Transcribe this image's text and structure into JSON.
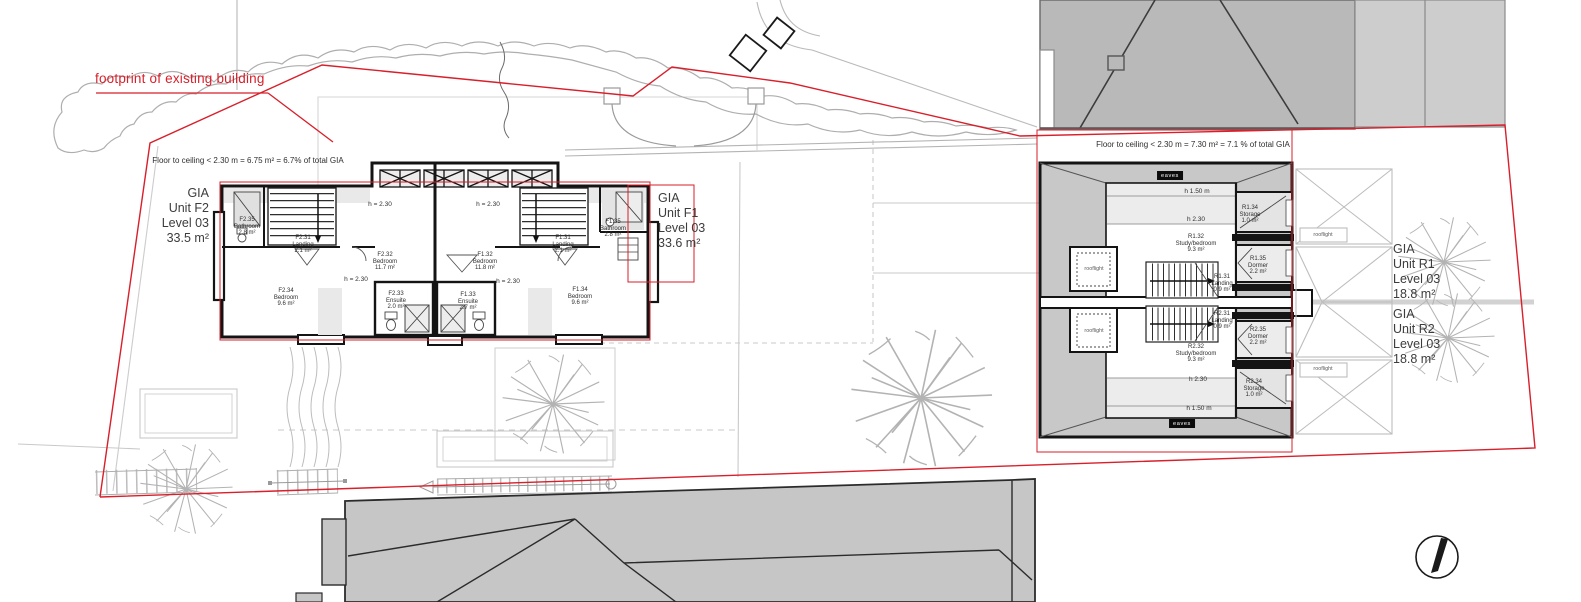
{
  "annotations": {
    "footprint": "footprint of existing building",
    "ceiling_left": "Floor to ceiling < 2.30 m = 6.75 m² = 6.7% of total GIA",
    "ceiling_right": "Floor to ceiling < 2.30 m = 7.30 m² = 7.1 % of total GIA",
    "eaves": "eaves",
    "rooflight": "rooflight",
    "h_eq_230": "h = 2.30",
    "h_230": "h 2.30",
    "h_150": "h 1.50 m"
  },
  "units": {
    "f2": {
      "gia": "GIA",
      "unit": "Unit F2",
      "level": "Level 03",
      "area": "33.5 m²"
    },
    "f1": {
      "gia": "GIA",
      "unit": "Unit F1",
      "level": "Level 03",
      "area": "33.6 m²"
    },
    "r1": {
      "gia": "GIA",
      "unit": "Unit R1",
      "level": "Level 03",
      "area": "18.8 m²"
    },
    "r2": {
      "gia": "GIA",
      "unit": "Unit R2",
      "level": "Level 03",
      "area": "18.8 m²"
    }
  },
  "rooms": {
    "f2_35": {
      "id": "F2.35",
      "name": "Bathroom",
      "area": "2.8 m²"
    },
    "f2_31": {
      "id": "F2.31",
      "name": "Landing",
      "area": "2.1 m²"
    },
    "f2_32": {
      "id": "F2.32",
      "name": "Bedroom",
      "area": "11.7 m²"
    },
    "f2_34": {
      "id": "F2.34",
      "name": "Bedroom",
      "area": "9.6 m²"
    },
    "f2_33": {
      "id": "F2.33",
      "name": "Ensuite",
      "area": "2.0 m²"
    },
    "f1_32": {
      "id": "F1.32",
      "name": "Bedroom",
      "area": "11.8 m²"
    },
    "f1_31": {
      "id": "F1.31",
      "name": "Landing",
      "area": "2.1 m²"
    },
    "f1_35": {
      "id": "F1.35",
      "name": "Bathroom",
      "area": "2.8 m²"
    },
    "f1_34": {
      "id": "F1.34",
      "name": "Bedroom",
      "area": "9.6 m²"
    },
    "f1_33": {
      "id": "F1.33",
      "name": "Ensuite",
      "area": "2.7 m²"
    },
    "r1_32": {
      "id": "R1.32",
      "name": "Study/bedroom",
      "area": "9.3 m²"
    },
    "r1_34": {
      "id": "R1.34",
      "name": "Storage",
      "area": "1.0 m²"
    },
    "r1_35": {
      "id": "R1.35",
      "name": "Dormer",
      "area": "2.2 m²"
    },
    "r1_31": {
      "id": "R1.31",
      "name": "Landing",
      "area": "0.9 m²"
    },
    "r2_31": {
      "id": "R2.31",
      "name": "Landing",
      "area": "0.9 m²"
    },
    "r2_35": {
      "id": "R2.35",
      "name": "Dormer",
      "area": "2.2 m²"
    },
    "r2_32": {
      "id": "R2.32",
      "name": "Study/bedroom",
      "area": "9.3 m²"
    },
    "r2_34": {
      "id": "R2.34",
      "name": "Storage",
      "area": "1.0 m²"
    }
  }
}
